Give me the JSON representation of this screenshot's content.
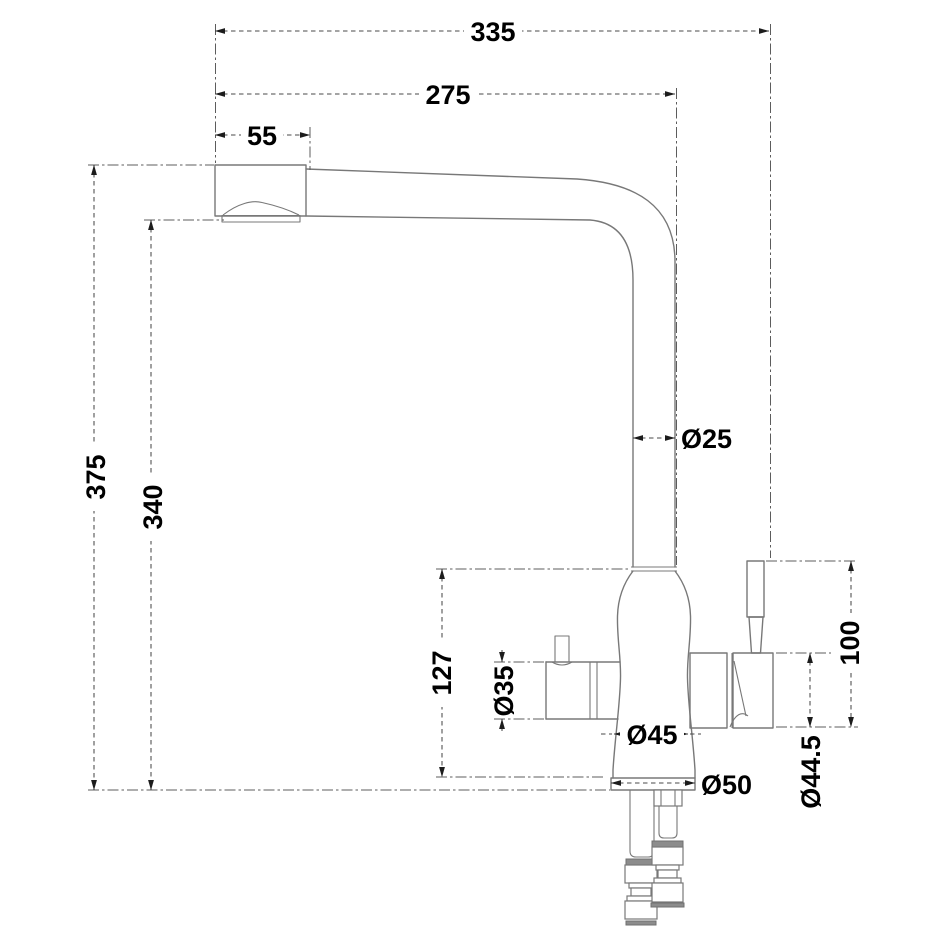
{
  "drawing": {
    "title": "Kitchen faucet with filter diverter - dimensional drawing",
    "view": "side elevation",
    "units": "mm",
    "colors": {
      "background": "#ffffff",
      "outline": "#787878",
      "dimension_lines": "#4a4a4a",
      "text": "#000000",
      "connector_fill": "#8c8c8c"
    },
    "dimensions": {
      "overall_reach": {
        "value": "335",
        "orientation": "horizontal"
      },
      "spout_reach": {
        "value": "275",
        "orientation": "horizontal"
      },
      "spout_head_length": {
        "value": "55",
        "orientation": "horizontal"
      },
      "overall_height": {
        "value": "375",
        "orientation": "vertical"
      },
      "spout_outlet_height": {
        "value": "340",
        "orientation": "vertical"
      },
      "riser_diameter": {
        "value": "Ø25",
        "orientation": "horizontal"
      },
      "body_height": {
        "value": "127",
        "orientation": "vertical"
      },
      "side_handle_diameter": {
        "value": "Ø35",
        "orientation": "vertical"
      },
      "body_diameter": {
        "value": "Ø45",
        "orientation": "horizontal"
      },
      "base_diameter": {
        "value": "Ø50",
        "orientation": "horizontal"
      },
      "diverter_lever_height": {
        "value": "100",
        "orientation": "vertical"
      },
      "diverter_body_diameter": {
        "value": "Ø44.5",
        "orientation": "vertical"
      }
    }
  }
}
